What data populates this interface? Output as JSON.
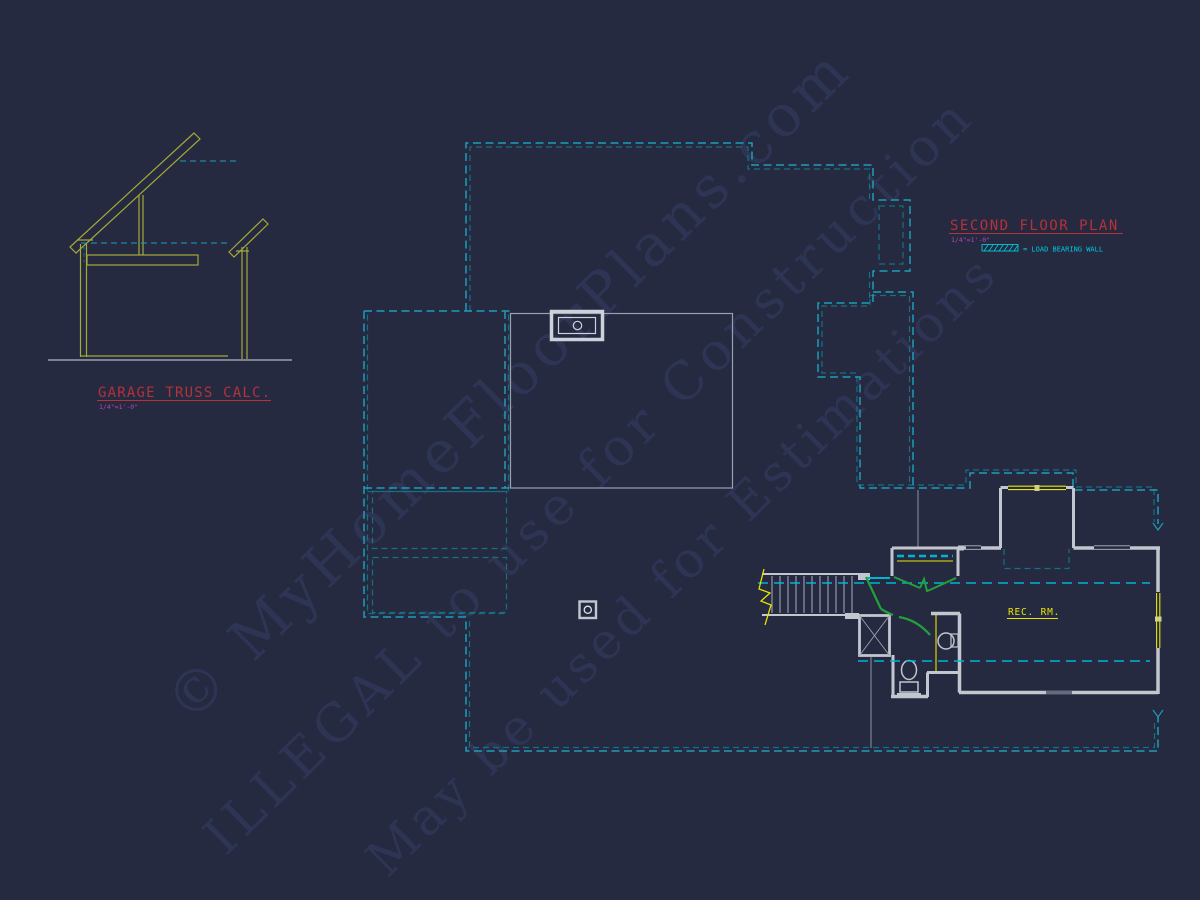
{
  "app": {
    "description": "CAD drawing viewport showing a second floor plan and garage truss calculation detail"
  },
  "truss_detail": {
    "title": "GARAGE TRUSS CALC.",
    "scale": "1/4\"=1'-0\""
  },
  "plan": {
    "title": "SECOND FLOOR PLAN",
    "scale": "1/4\"=1'-0\"",
    "room_label": "REC. RM."
  },
  "legend": {
    "label": "= LOAD BEARING WALL"
  },
  "watermark": {
    "line1": "©  MyHomeFloorPlans.com",
    "line2": "ILLEGAL to use for Construction",
    "line3": "May be used for Estimations"
  },
  "colors": {
    "background": "#252a40",
    "outline_cyan": "#1f9cbb",
    "outline_teal": "#15707f",
    "bright_dash_cyan": "#00b5d4",
    "legend_cyan": "#00c8dc",
    "wall_gray": "#c2c6ce",
    "light_gray": "#9aa0af",
    "title_red": "#b4323a",
    "scale_magenta": "#b844b8",
    "yellow": "#e9e400",
    "truss_olive": "#a6a838",
    "door_green": "#21a13d",
    "watermark_blue": "#3f4775"
  }
}
